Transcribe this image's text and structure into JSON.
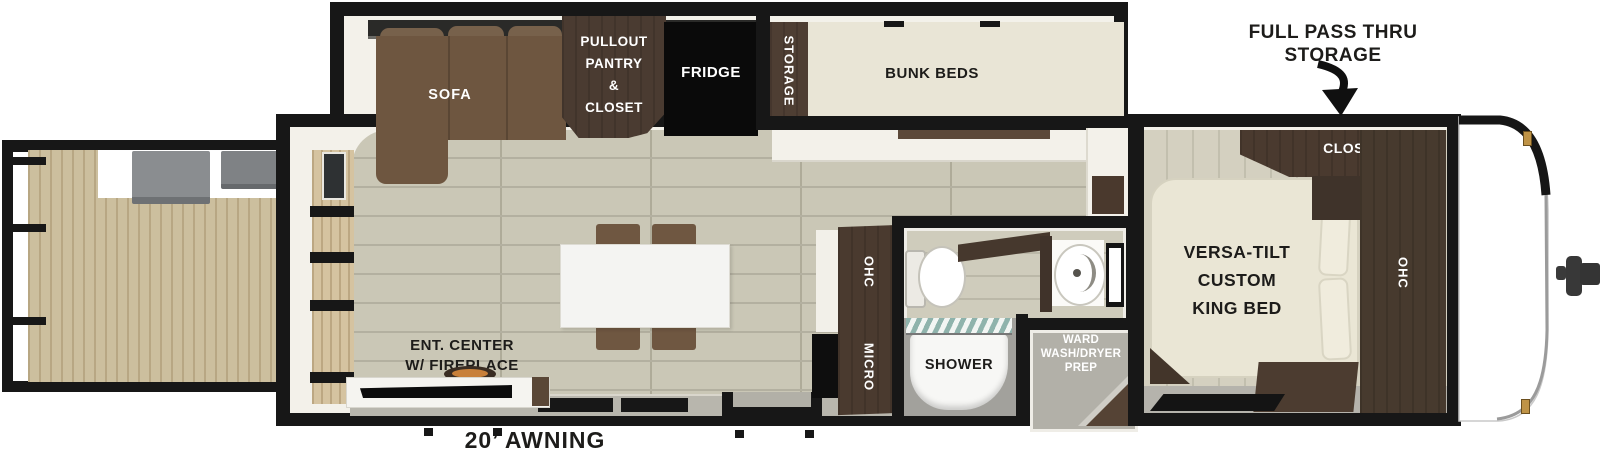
{
  "palette": {
    "wall_black": "#171717",
    "floor_plank": "#cac7b6",
    "deck_wood": "#ccbf9e",
    "cabinet_dark_brown": "#4a3a2f",
    "sofa_brown": "#6e5640",
    "mattress_beige": "#eae6d5",
    "shower_teal": "#8fb3ac",
    "latch_gold": "#bf9346"
  },
  "callouts": {
    "pass_thru": {
      "line1": "FULL PASS THRU",
      "line2": "STORAGE"
    },
    "awning": "20’ AWNING"
  },
  "front_bedroom": {
    "closet": "CLOSET",
    "bed": {
      "line1": "VERSA-TILT",
      "line2": "CUSTOM",
      "line3": "KING BED"
    },
    "ohc": "OHC"
  },
  "bunk_area": {
    "bunk_beds": "BUNK BEDS",
    "storage": "STORAGE"
  },
  "kitchen": {
    "fridge": "FRIDGE",
    "pantry": {
      "line1": "PULLOUT",
      "line2": "PANTRY",
      "line3": "&",
      "line4": "CLOSET"
    },
    "ohc": "OHC",
    "micro": "MICRO"
  },
  "living": {
    "sofa": "SOFA",
    "ent_center": {
      "line1": "ENT. CENTER",
      "line2": "W/ FIREPLACE"
    }
  },
  "bathroom": {
    "shower": "SHOWER",
    "ward": {
      "line1": "WARD",
      "line2": "WASH/DRYER",
      "line3": "PREP"
    }
  }
}
